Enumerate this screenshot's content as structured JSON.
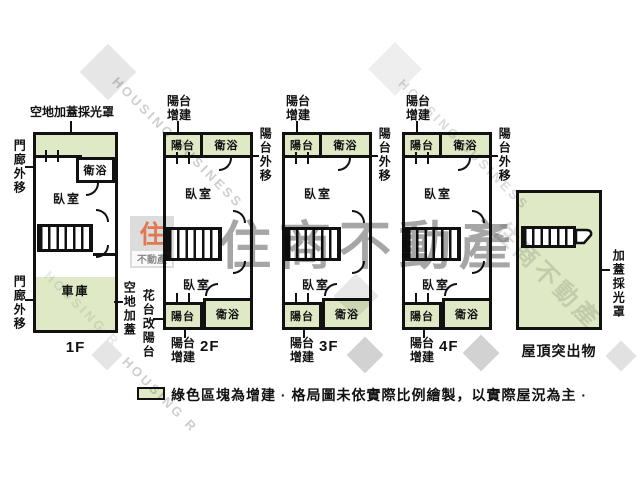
{
  "legend": {
    "text": "綠色區塊為增建 · 格局圖未依實際比例繪製，以實際屋況為主 ·",
    "swatch_color": "#dfe9c6"
  },
  "colors": {
    "addition_green": "#dfe9c6",
    "wall": "#111111",
    "logo_orange": "#e0663c"
  },
  "watermark": {
    "brand": "住商不動產",
    "brand_en": "HOUSING BUSINESS",
    "brand_en_short": "HOUSING R",
    "logo_top": "住",
    "logo_bottom": "不動產"
  },
  "floors": {
    "f1": {
      "label": "1F",
      "rooms": {
        "bath": "衛浴",
        "bedroom": "臥室",
        "garage": "車庫"
      },
      "annotations": {
        "top": "空地加蓋採光罩",
        "left_top": "門廊外移",
        "left_bottom": "門廊外移",
        "right": "空地加蓋"
      }
    },
    "f2": {
      "label": "2F",
      "rooms": {
        "balcony_top": "陽台",
        "bath_top": "衛浴",
        "bedroom_top": "臥室",
        "bedroom_bottom": "臥室",
        "balcony_bottom": "陽台",
        "bath_bottom": "衛浴"
      },
      "annotations": {
        "top": "陽台增建",
        "right": "陽台外移",
        "left": "花台改陽台",
        "bottom": "陽台增建"
      }
    },
    "f3": {
      "label": "3F",
      "rooms": {
        "balcony_top": "陽台",
        "bath_top": "衛浴",
        "bedroom_top": "臥室",
        "bedroom_bottom": "臥室",
        "balcony_bottom": "陽台",
        "bath_bottom": "衛浴"
      },
      "annotations": {
        "top": "陽台增建",
        "right": "陽台外移",
        "bottom": "陽台增建"
      }
    },
    "f4": {
      "label": "4F",
      "rooms": {
        "balcony_top": "陽台",
        "bath_top": "衛浴",
        "bedroom_top": "臥室",
        "bedroom_bottom": "臥室",
        "balcony_bottom": "陽台",
        "bath_bottom": "衛浴"
      },
      "annotations": {
        "top": "陽台增建",
        "right": "陽台外移",
        "bottom": "陽台增建"
      }
    },
    "roof": {
      "label": "屋頂突出物",
      "annotations": {
        "right": "加蓋採光罩"
      }
    }
  }
}
